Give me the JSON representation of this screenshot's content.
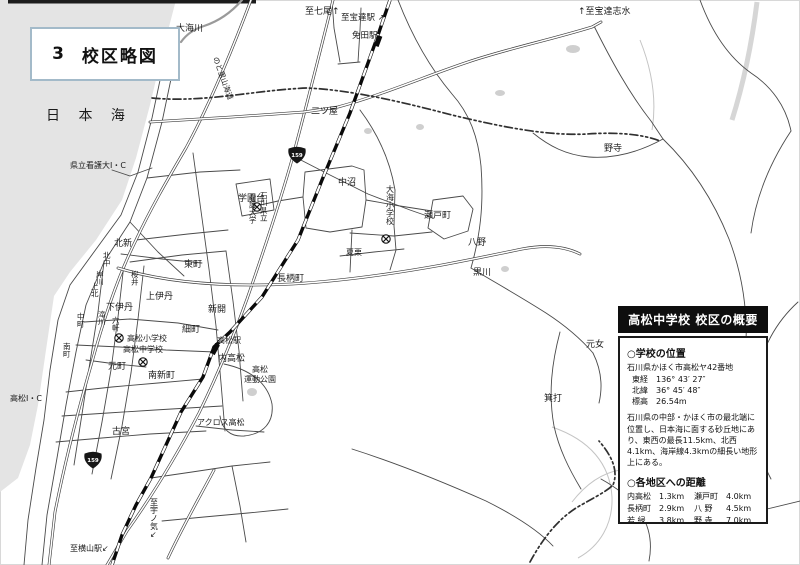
{
  "title_box": {
    "number": "3",
    "title": "校区略図"
  },
  "infobox": {
    "header": "高松中学校 校区の概要",
    "location_title": "○学校の位置",
    "address": "石川県かほく市高松ヤ42番地",
    "coords": [
      {
        "label": "東経",
        "value": "136° 43′ 27″"
      },
      {
        "label": "北緯",
        "value": "36° 45′ 48″"
      },
      {
        "label": "標高",
        "value": "26.54m"
      }
    ],
    "description": "石川県の中部・かほく市の最北端に位置し、日本海に面する砂丘地にあり、東西の最長11.5km、北西4.1km、海岸線4.3kmの細長い地形上にある。",
    "distance_title": "○各地区への距離",
    "distances_left": [
      {
        "name": "内高松",
        "value": "1.3km"
      },
      {
        "name": "長柄町",
        "value": "2.9km"
      },
      {
        "name": "若 緑",
        "value": "3.8km"
      },
      {
        "name": "二ツ屋",
        "value": "4.0km"
      },
      {
        "name": "中 沼",
        "value": "3.4km"
      },
      {
        "name": "夏 栗",
        "value": "3.5km"
      }
    ],
    "distances_right": [
      {
        "name": "瀬戸町",
        "value": "4.0km"
      },
      {
        "name": "八 野",
        "value": "4.5km"
      },
      {
        "name": "野 寺",
        "value": "7.0km"
      },
      {
        "name": "黒 川",
        "value": "5.0km"
      },
      {
        "name": "元 女",
        "value": "6.5km"
      },
      {
        "name": "箕 打",
        "value": "7.0km"
      }
    ]
  },
  "map": {
    "labels": [
      {
        "id": "sea-nihonkai",
        "text": "日 本 海",
        "x": 46,
        "y": 120,
        "size": 14,
        "mode": "h",
        "ls": 7
      },
      {
        "id": "river-omigawa",
        "text": "大海川",
        "x": 176,
        "y": 31,
        "size": 9,
        "mode": "h"
      },
      {
        "id": "route-noto-satoyama-kaido",
        "text": "のと里山海道",
        "x": 213,
        "y": 58,
        "size": 7.5,
        "mode": "h",
        "rot": 70
      },
      {
        "id": "to-nanao",
        "text": "至七尾↑",
        "x": 305,
        "y": 14,
        "size": 9,
        "mode": "h"
      },
      {
        "id": "to-hodatsu-station",
        "text": "至宝達駅 ↗",
        "x": 341,
        "y": 20,
        "size": 8.5,
        "mode": "h"
      },
      {
        "id": "menden-station",
        "text": "免田駅",
        "x": 352,
        "y": 38,
        "size": 8.5,
        "mode": "h"
      },
      {
        "id": "to-hodatsushimizu",
        "text": "↑至宝達志水",
        "x": 578,
        "y": 14,
        "size": 9,
        "mode": "h"
      },
      {
        "id": "futatsuya",
        "text": "二ツ屋",
        "x": 311,
        "y": 114,
        "size": 9,
        "mode": "h"
      },
      {
        "id": "nodera",
        "text": "野寺",
        "x": 604,
        "y": 151,
        "size": 9,
        "mode": "h"
      },
      {
        "id": "kenritsu-kango-dai-ic",
        "text": "県立看護大I・C",
        "x": 70,
        "y": 168,
        "size": 8,
        "mode": "h"
      },
      {
        "id": "gakuendai",
        "text": "学園台",
        "x": 238,
        "y": 201,
        "size": 9,
        "mode": "h"
      },
      {
        "id": "ishikawa-kenritsu",
        "text": "石川県立",
        "x": 260,
        "y": 198,
        "size": 7.5,
        "mode": "v"
      },
      {
        "id": "kango-daigaku",
        "text": "看護大学",
        "x": 249,
        "y": 200,
        "size": 7.5,
        "mode": "v"
      },
      {
        "id": "nakanuma",
        "text": "中沼",
        "x": 338,
        "y": 185,
        "size": 9,
        "mode": "h"
      },
      {
        "id": "omi-elementary",
        "text": "大海小学校",
        "x": 386,
        "y": 192,
        "size": 8,
        "mode": "v"
      },
      {
        "id": "setomachi",
        "text": "瀬戸町",
        "x": 424,
        "y": 218,
        "size": 9,
        "mode": "h"
      },
      {
        "id": "natsuguri",
        "text": "夏栗",
        "x": 346,
        "y": 255,
        "size": 8,
        "mode": "h"
      },
      {
        "id": "hachino",
        "text": "八野",
        "x": 468,
        "y": 245,
        "size": 9,
        "mode": "h"
      },
      {
        "id": "kurokawa",
        "text": "黒川",
        "x": 473,
        "y": 275,
        "size": 9,
        "mode": "h"
      },
      {
        "id": "nagaramachi",
        "text": "長柄町",
        "x": 277,
        "y": 281,
        "size": 9,
        "mode": "h"
      },
      {
        "id": "kitashin",
        "text": "北新",
        "x": 114,
        "y": 246,
        "size": 9,
        "mode": "h"
      },
      {
        "id": "higashimachi",
        "text": "東町",
        "x": 184,
        "y": 267,
        "size": 9,
        "mode": "h"
      },
      {
        "id": "kitanaka",
        "text": "北中",
        "x": 103,
        "y": 258,
        "size": 7.5,
        "mode": "v"
      },
      {
        "id": "kamikita",
        "text": "上北",
        "x": 91,
        "y": 289,
        "size": 7.5,
        "mode": "v"
      },
      {
        "id": "nakamachi",
        "text": "中町",
        "x": 77,
        "y": 319,
        "size": 7.5,
        "mode": "v"
      },
      {
        "id": "minamimachi",
        "text": "南町",
        "x": 63,
        "y": 349,
        "size": 7.5,
        "mode": "v"
      },
      {
        "id": "kishikawa",
        "text": "岸川",
        "x": 96,
        "y": 277,
        "size": 7.5,
        "mode": "v"
      },
      {
        "id": "sakurai",
        "text": "桜井",
        "x": 131,
        "y": 277,
        "size": 7.5,
        "mode": "v"
      },
      {
        "id": "takigawa",
        "text": "滝川",
        "x": 98,
        "y": 317,
        "size": 7.5,
        "mode": "v"
      },
      {
        "id": "rokken",
        "text": "六軒",
        "x": 112,
        "y": 323,
        "size": 7.5,
        "mode": "v"
      },
      {
        "id": "kamiidan",
        "text": "上伊丹",
        "x": 146,
        "y": 299,
        "size": 9,
        "mode": "h"
      },
      {
        "id": "shimoidan",
        "text": "下伊丹",
        "x": 106,
        "y": 310,
        "size": 9,
        "mode": "h"
      },
      {
        "id": "shinkai",
        "text": "新開",
        "x": 208,
        "y": 312,
        "size": 9,
        "mode": "h"
      },
      {
        "id": "hosomachi",
        "text": "細町",
        "x": 182,
        "y": 332,
        "size": 9,
        "mode": "h"
      },
      {
        "id": "takamatsu-elementary",
        "text": "高松小学校",
        "x": 127,
        "y": 341,
        "size": 8,
        "mode": "h"
      },
      {
        "id": "takamatsu-junior-high",
        "text": "高松中学校",
        "x": 123,
        "y": 352,
        "size": 8,
        "mode": "h"
      },
      {
        "id": "takamatsu-station",
        "text": "高松駅",
        "x": 217,
        "y": 343,
        "size": 8,
        "mode": "h"
      },
      {
        "id": "uchitakamatsu",
        "text": "内高松",
        "x": 218,
        "y": 361,
        "size": 9,
        "mode": "h"
      },
      {
        "id": "takamatsu-sports-park-1",
        "text": "高松",
        "x": 252,
        "y": 372,
        "size": 8,
        "mode": "h"
      },
      {
        "id": "takamatsu-sports-park-2",
        "text": "運動公園",
        "x": 244,
        "y": 382,
        "size": 8,
        "mode": "h"
      },
      {
        "id": "minamishinmachi",
        "text": "南新町",
        "x": 148,
        "y": 378,
        "size": 9,
        "mode": "h"
      },
      {
        "id": "motomachi",
        "text": "元町",
        "x": 108,
        "y": 369,
        "size": 9,
        "mode": "h"
      },
      {
        "id": "across-takamatsu",
        "text": "アクロス高松",
        "x": 197,
        "y": 425,
        "size": 8,
        "mode": "h"
      },
      {
        "id": "furumiya",
        "text": "古宮",
        "x": 112,
        "y": 434,
        "size": 9,
        "mode": "h"
      },
      {
        "id": "takamatsu-ic",
        "text": "高松I・C",
        "x": 10,
        "y": 401,
        "size": 8,
        "mode": "h"
      },
      {
        "id": "motome",
        "text": "元女",
        "x": 586,
        "y": 347,
        "size": 9,
        "mode": "h"
      },
      {
        "id": "minouchi",
        "text": "箕打",
        "x": 544,
        "y": 401,
        "size": 9,
        "mode": "h"
      },
      {
        "id": "to-yokoyama-station",
        "text": "至横山駅↙",
        "x": 70,
        "y": 551,
        "size": 8,
        "mode": "h"
      },
      {
        "id": "to-unoke",
        "text": "至宇ノ気↙",
        "x": 150,
        "y": 505,
        "size": 8,
        "mode": "v"
      }
    ],
    "shields": [
      {
        "number": "159",
        "x": 297,
        "y": 155
      },
      {
        "number": "159",
        "x": 93,
        "y": 460
      }
    ],
    "school_symbols": [
      {
        "id": "kango-daigaku-symbol",
        "x": 257,
        "y": 207
      },
      {
        "id": "omi-elementary-symbol",
        "x": 386,
        "y": 239
      },
      {
        "id": "takamatsu-elementary-symbol",
        "x": 119,
        "y": 338
      },
      {
        "id": "takamatsu-junior-high-symbol",
        "x": 143,
        "y": 362
      }
    ],
    "stations": [
      {
        "id": "menden-station-mark",
        "x": 378,
        "y": 41,
        "angle": -70
      },
      {
        "id": "takamatsu-station-mark",
        "x": 215,
        "y": 349,
        "angle": -62
      }
    ]
  }
}
